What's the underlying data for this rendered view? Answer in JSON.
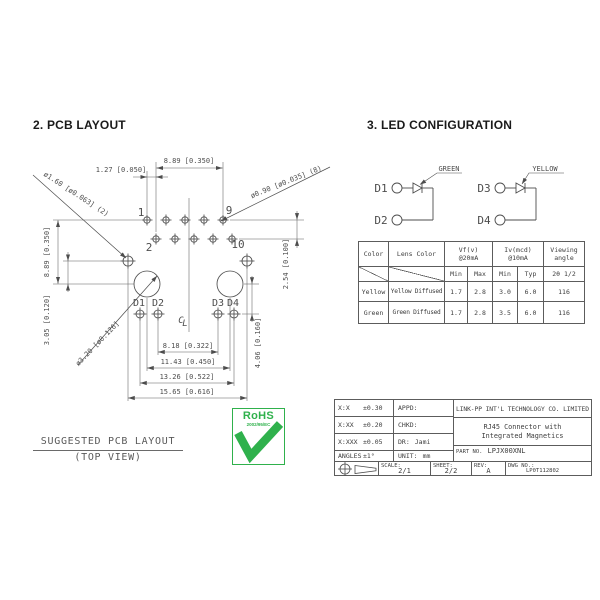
{
  "sections": {
    "pcb_title": "2. PCB LAYOUT",
    "led_title": "3. LED CONFIGURATION"
  },
  "pcb": {
    "caption1": "SUGGESTED PCB LAYOUT",
    "caption2": "(TOP VIEW)",
    "pin1": "1",
    "pin2": "2",
    "pin9": "9",
    "pin10": "10",
    "d1": "D1",
    "d2": "D2",
    "d3": "D3",
    "d4": "D4",
    "cl_c": "C",
    "cl_l": "L",
    "dim_top_span": "8.89 [0.350]",
    "dim_row_offset": "1.27 [0.050]",
    "dim_small_hole": "ø1.60 [ø0.063] (2)",
    "dim_pad_hole": "ø0.90 [ø0.035] (8)",
    "dim_left_span": "8.89 [0.350]",
    "dim_hole_gap": "3.05 [0.120]",
    "dim_post_hole": "ø3.20 [ø0.126]",
    "dim_row_pitch": "2.54 [0.100]",
    "dim_led_drop": "4.06 [0.160]",
    "dim_led_inner": "8.18 [0.322]",
    "dim_post_span": "11.43 [0.450]",
    "dim_led_outer": "13.26 [0.522]",
    "dim_hole_span": "15.65 [0.616]"
  },
  "led": {
    "g_top": "D1",
    "g_bottom": "D2",
    "g_color": "GREEN",
    "y_top": "D3",
    "y_bottom": "D4",
    "y_color": "YELLOW",
    "table": {
      "h_color": "Color",
      "h_lens": "Lens Color",
      "h_vf": "Vf(v)",
      "h_vf2": "@20mA",
      "h_iv": "Iv(mcd)",
      "h_iv2": "@10mA",
      "h_view": "Viewing",
      "h_view2": "angle",
      "s_min": "Min",
      "s_max": "Max",
      "s_min2": "Min",
      "s_typ": "Typ",
      "s_angle": "2θ 1/2",
      "rows": [
        {
          "color": "Yellow",
          "lens": "Yellow Diffused",
          "vf_min": "1.7",
          "vf_max": "2.8",
          "iv_min": "3.0",
          "iv_typ": "6.0",
          "va": "116"
        },
        {
          "color": "Green",
          "lens": "Green Diffused",
          "vf_min": "1.7",
          "vf_max": "2.8",
          "iv_min": "3.5",
          "iv_typ": "6.0",
          "va": "116"
        }
      ]
    }
  },
  "rohs": {
    "name": "RoHS",
    "directive": "2002/95/EC"
  },
  "tb": {
    "tol": [
      {
        "l": "X:X",
        "v": "±0.30"
      },
      {
        "l": "X:XX",
        "v": "±0.20"
      },
      {
        "l": "X:XXX",
        "v": "±0.05"
      },
      {
        "l": "ANGLES",
        "v": "±1°"
      }
    ],
    "app": [
      {
        "l": "APPD:",
        "v": ""
      },
      {
        "l": "CHKD:",
        "v": ""
      },
      {
        "l": "DR:",
        "v": "Jami"
      },
      {
        "l": "UNIT:",
        "v": "mm"
      }
    ],
    "company": "LINK-PP INT'L TECHNOLOGY CO. LIMITED",
    "product1": "RJ45 Connector with",
    "product2": "Integrated Magnetics",
    "part_label": "PART NO.",
    "part_no": "LPJX00XNL",
    "scale_label": "SCALE:",
    "scale": "2/1",
    "sheet_label": "SHEET:",
    "sheet": "2/2",
    "rev_label": "REV:",
    "rev": "A",
    "dwg_label": "DWG NO.:",
    "dwg_no": "LP0T112802"
  }
}
